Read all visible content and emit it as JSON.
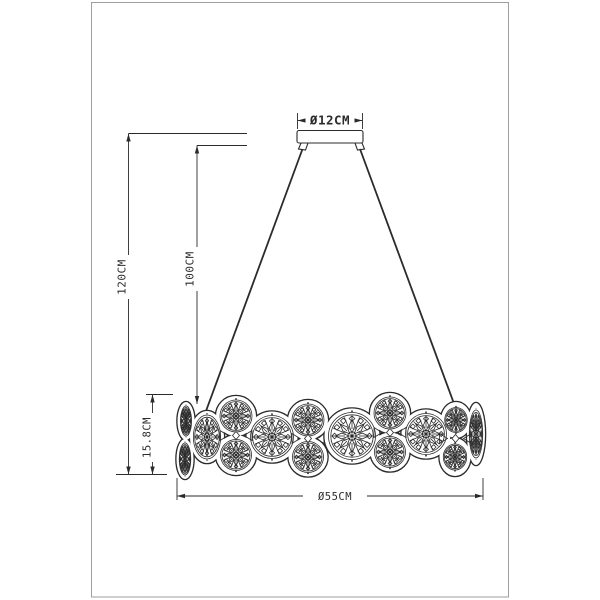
{
  "drawing": {
    "background": "#ffffff",
    "frame_color": "#9e9e9e",
    "line_color": "#2b2b2b",
    "labels": {
      "canopy_diameter": "Ø12CM",
      "overall_height": "120CM",
      "suspension_length": "100CM",
      "ring_height": "15.8CM",
      "ring_diameter": "Ø55CM"
    }
  }
}
